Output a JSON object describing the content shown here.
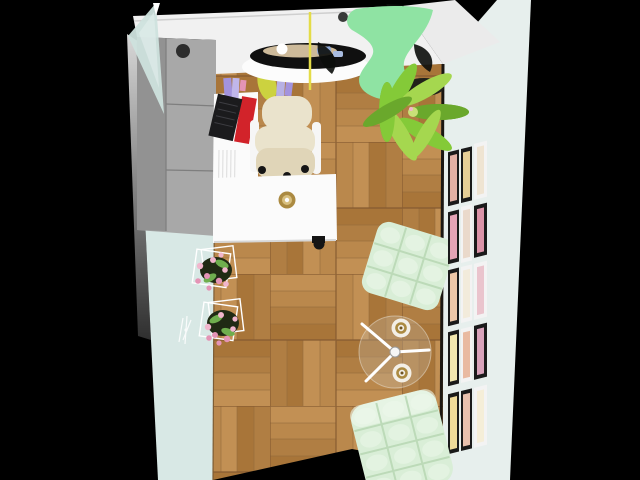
{
  "scene": {
    "description": "Top-down 3D render of a small home office room on a black background",
    "objects": [
      "gray-wardrobe",
      "glass-door-panel",
      "wall-shelf-with-books",
      "red-binder",
      "black-keyboard",
      "purple-books",
      "lavender-books",
      "yellow-vase",
      "cream-office-chair",
      "white-desk",
      "gold-cup",
      "black-round-table-with-dishes",
      "pendant-cord",
      "green-panton-chair",
      "potted-plant",
      "wire-flower-planter-upper",
      "wire-flower-planter-lower",
      "wall-sconce-sketch",
      "mint-tufted-ottoman",
      "glass-tripod-coffee-table",
      "white-gold-cup-1",
      "white-gold-cup-2",
      "mint-tufted-chair",
      "gallery-wall",
      "parquet-floor",
      "mint-left-wall",
      "gallery-right-wall"
    ]
  },
  "colors": {
    "bg": "#000000",
    "topWall": "#f1f1f1",
    "bandEdge": "#cfcfcf",
    "sliver": "#ebebeb",
    "rightWall": "#e7efed",
    "leftWall": "#d8e8e5",
    "leftOuterTop": "#d8d8d8",
    "leftOuterBottom": "#2f2f2f",
    "glass": "#cde1dd",
    "glassHi": "#e2efec",
    "wardrobe": "#a8a8a8",
    "wardrobeDark": "#929292",
    "wardrobeSeam": "#7e7e7e",
    "knob": "#2d2d2d",
    "desk": "#fbfbfb",
    "deskShadow": "#d6d6d6",
    "cream": "#eae3cc",
    "creamDark": "#e0d5b8",
    "arm": "#f6f6f6",
    "black": "#151515",
    "lamp": "#101010",
    "cordYellow": "#e4dc48",
    "whiteEll": "#fcfcfc",
    "beige": "#d8c4a2",
    "blue": "#8ea8d6",
    "blueLight": "#a9bce0",
    "white": "#ffffff",
    "panton": "#8fe3a3",
    "shadowDark": "#0b0d0b",
    "plant1": "#6aa82c",
    "plant2": "#84ca38",
    "plant3": "#a5d74f",
    "pot": "#21211a",
    "mint": "#d9eed7",
    "mintHi": "#eef8ec",
    "mintShade": "#b9d8b5",
    "gold": "#ab8a41",
    "goldLight": "#d8bf7e",
    "red": "#d2232a",
    "keyboard": "#1b1b1d",
    "purple1": "#a393dd",
    "purple2": "#c0b6ea",
    "lavender": "#b7b0e4",
    "yellowObj": "#ccd23f",
    "soil": "#202a14",
    "leaf": "#6fae4e",
    "pink1": "#f1b6cd",
    "pink2": "#e494b6",
    "cup": "#f3efe6",
    "glassTop": "#cbbfae",
    "plankA": "#c29054",
    "plankB": "#b07e43",
    "plankC": "#ba884c",
    "plankD": "#a87539",
    "plankSeam": "#8f673a",
    "tileBorder": "#83592f",
    "floorSeam": "#7d5c34",
    "wallEdgeShadow": "#1b1712",
    "spine": "#d8d8d8"
  },
  "gallery": {
    "rows": 5,
    "cols": 3,
    "frames": [
      {
        "mat": "#1a1a1a",
        "art": "#e2b0a4"
      },
      {
        "mat": "#1a1a1a",
        "art": "#e6cf96"
      },
      {
        "mat": "#f3f3f3",
        "art": "#efe4d2"
      },
      {
        "mat": "#1a1a1a",
        "art": "#e5a4b6"
      },
      {
        "mat": "#f3f3f3",
        "art": "#ead9cb"
      },
      {
        "mat": "#1a1a1a",
        "art": "#db93a8"
      },
      {
        "mat": "#1a1a1a",
        "art": "#eec8a8"
      },
      {
        "mat": "#f3f3f3",
        "art": "#f2ebdb"
      },
      {
        "mat": "#f3f3f3",
        "art": "#eac4cd"
      },
      {
        "mat": "#1a1a1a",
        "art": "#f3e8af"
      },
      {
        "mat": "#f3f3f3",
        "art": "#e9baa1"
      },
      {
        "mat": "#1a1a1a",
        "art": "#d8a2ba"
      },
      {
        "mat": "#1a1a1a",
        "art": "#efdb99"
      },
      {
        "mat": "#1a1a1a",
        "art": "#e9c1ae"
      },
      {
        "mat": "#f3f3f3",
        "art": "#f5eed8"
      }
    ]
  }
}
